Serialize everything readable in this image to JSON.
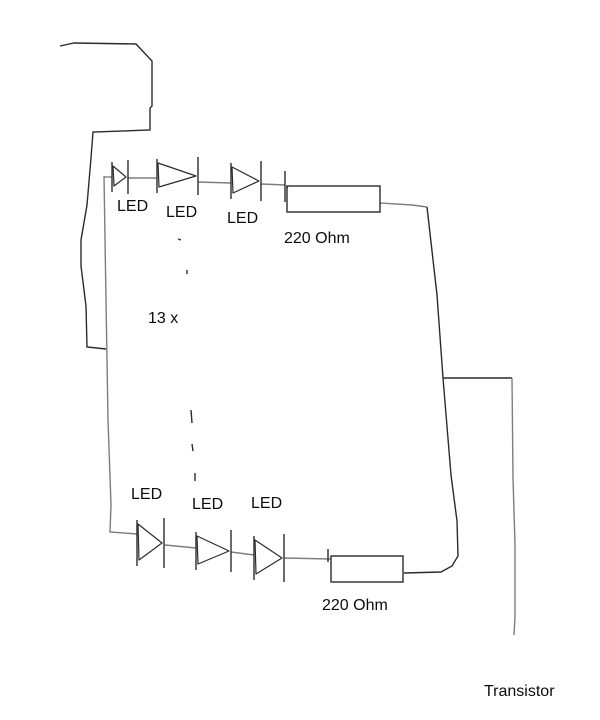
{
  "diagram": {
    "title": "LED circuit sketch",
    "canvas": {
      "width": 600,
      "height": 720,
      "background": "#ffffff"
    },
    "colors": {
      "wire": "#7e7e7e",
      "ink": "#2b2b2b",
      "text": "#0c0c0c"
    },
    "labels": [
      {
        "id": "label-led-top-1",
        "text": "LED",
        "x": 117,
        "y": 198
      },
      {
        "id": "label-led-top-2",
        "text": "LED",
        "x": 166,
        "y": 204
      },
      {
        "id": "label-led-top-3",
        "text": "LED",
        "x": 227,
        "y": 210
      },
      {
        "id": "label-resistor-top",
        "text": "220 Ohm",
        "x": 284,
        "y": 230
      },
      {
        "id": "label-multiplier",
        "text": "13 x",
        "x": 148,
        "y": 310
      },
      {
        "id": "label-led-bottom-1",
        "text": "LED",
        "x": 131,
        "y": 486
      },
      {
        "id": "label-led-bottom-2",
        "text": "LED",
        "x": 192,
        "y": 496
      },
      {
        "id": "label-led-bottom-3",
        "text": "LED",
        "x": 251,
        "y": 495
      },
      {
        "id": "label-resistor-bottom",
        "text": "220 Ohm",
        "x": 322,
        "y": 597
      },
      {
        "id": "label-transistor",
        "text": "Transistor",
        "x": 484,
        "y": 683
      }
    ],
    "wires": [
      {
        "id": "top-left-feed",
        "stroke": "ink",
        "path": "M60,46 L74,43 L136,44 L152,61 L152,106 L150,108 L150,130 L93,132 L91,158 L87,205 L81,240 L81,266 L86,306 L87,347 L106,349"
      },
      {
        "id": "left-rail",
        "stroke": "wire",
        "path": "M104,176 L106,300 L108,420 L111,505 L110,532 L137,534"
      },
      {
        "id": "top-row-seg-1",
        "stroke": "wire",
        "path": "M104,177 L112,177"
      },
      {
        "id": "top-row-seg-2",
        "stroke": "wire",
        "path": "M128,178 L157,178"
      },
      {
        "id": "top-row-seg-3",
        "stroke": "wire",
        "path": "M198,182 L231,183"
      },
      {
        "id": "top-row-seg-4",
        "stroke": "wire",
        "path": "M261,184 L285,185"
      },
      {
        "id": "top-tick",
        "stroke": "ink",
        "path": "M285,171 L285,202"
      },
      {
        "id": "top-resistor-in",
        "stroke": "wire",
        "path": "M285,186 L288,188"
      },
      {
        "id": "top-resistor-out",
        "stroke": "wire",
        "path": "M380,203 L412,205 L427,207"
      },
      {
        "id": "right-diagonal",
        "stroke": "ink",
        "path": "M427,207 L437,295 L443,378"
      },
      {
        "id": "branch-horizontal",
        "stroke": "ink",
        "path": "M443,378 L512,378"
      },
      {
        "id": "transistor-lead",
        "stroke": "wire",
        "path": "M512,378 L513,478 L515,545 L515,616 L514,635"
      },
      {
        "id": "right-descent",
        "stroke": "ink",
        "path": "M443,378 L451,475 L457,521 L458,556 L452,566 L441,572 L404,573"
      },
      {
        "id": "bottom-resistor-in",
        "stroke": "wire",
        "path": "M284,558 L331,559"
      },
      {
        "id": "bottom-tick",
        "stroke": "ink",
        "path": "M328,549 L328,562"
      },
      {
        "id": "bottom-row-seg-2",
        "stroke": "wire",
        "path": "M165,545 L196,548"
      },
      {
        "id": "bottom-row-seg-3",
        "stroke": "wire",
        "path": "M231,552 L254,555"
      },
      {
        "id": "divider-dot-1",
        "stroke": "ink",
        "path": "M178,239 L181,240"
      },
      {
        "id": "divider-dot-2",
        "stroke": "ink",
        "path": "M187,270 L187,274"
      },
      {
        "id": "divider-dash-1",
        "stroke": "ink",
        "path": "M191,410 L192,423"
      },
      {
        "id": "divider-dash-2",
        "stroke": "ink",
        "path": "M192,444 L193,451"
      },
      {
        "id": "divider-dash-3",
        "stroke": "ink",
        "path": "M195,473 L195,481"
      }
    ],
    "resistors": [
      {
        "id": "resistor-top-body",
        "x": 287,
        "y": 186,
        "w": 93,
        "h": 26
      },
      {
        "id": "resistor-bottom-body",
        "x": 331,
        "y": 556,
        "w": 72,
        "h": 26
      }
    ],
    "leds": [
      {
        "id": "led-top-1-symbol",
        "x1": 112,
        "x2": 128,
        "cy": 177,
        "bh": 30
      },
      {
        "id": "led-top-2-symbol",
        "x1": 157,
        "x2": 198,
        "cy": 176,
        "bh": 34
      },
      {
        "id": "led-top-3-symbol",
        "x1": 231,
        "x2": 261,
        "cy": 181,
        "bh": 36
      },
      {
        "id": "led-bottom-1-symbol",
        "x1": 137,
        "x2": 164,
        "cy": 543,
        "bh": 46
      },
      {
        "id": "led-bottom-2-symbol",
        "x1": 196,
        "x2": 231,
        "cy": 551,
        "bh": 38
      },
      {
        "id": "led-bottom-3-symbol",
        "x1": 254,
        "x2": 284,
        "cy": 558,
        "bh": 44
      }
    ]
  }
}
